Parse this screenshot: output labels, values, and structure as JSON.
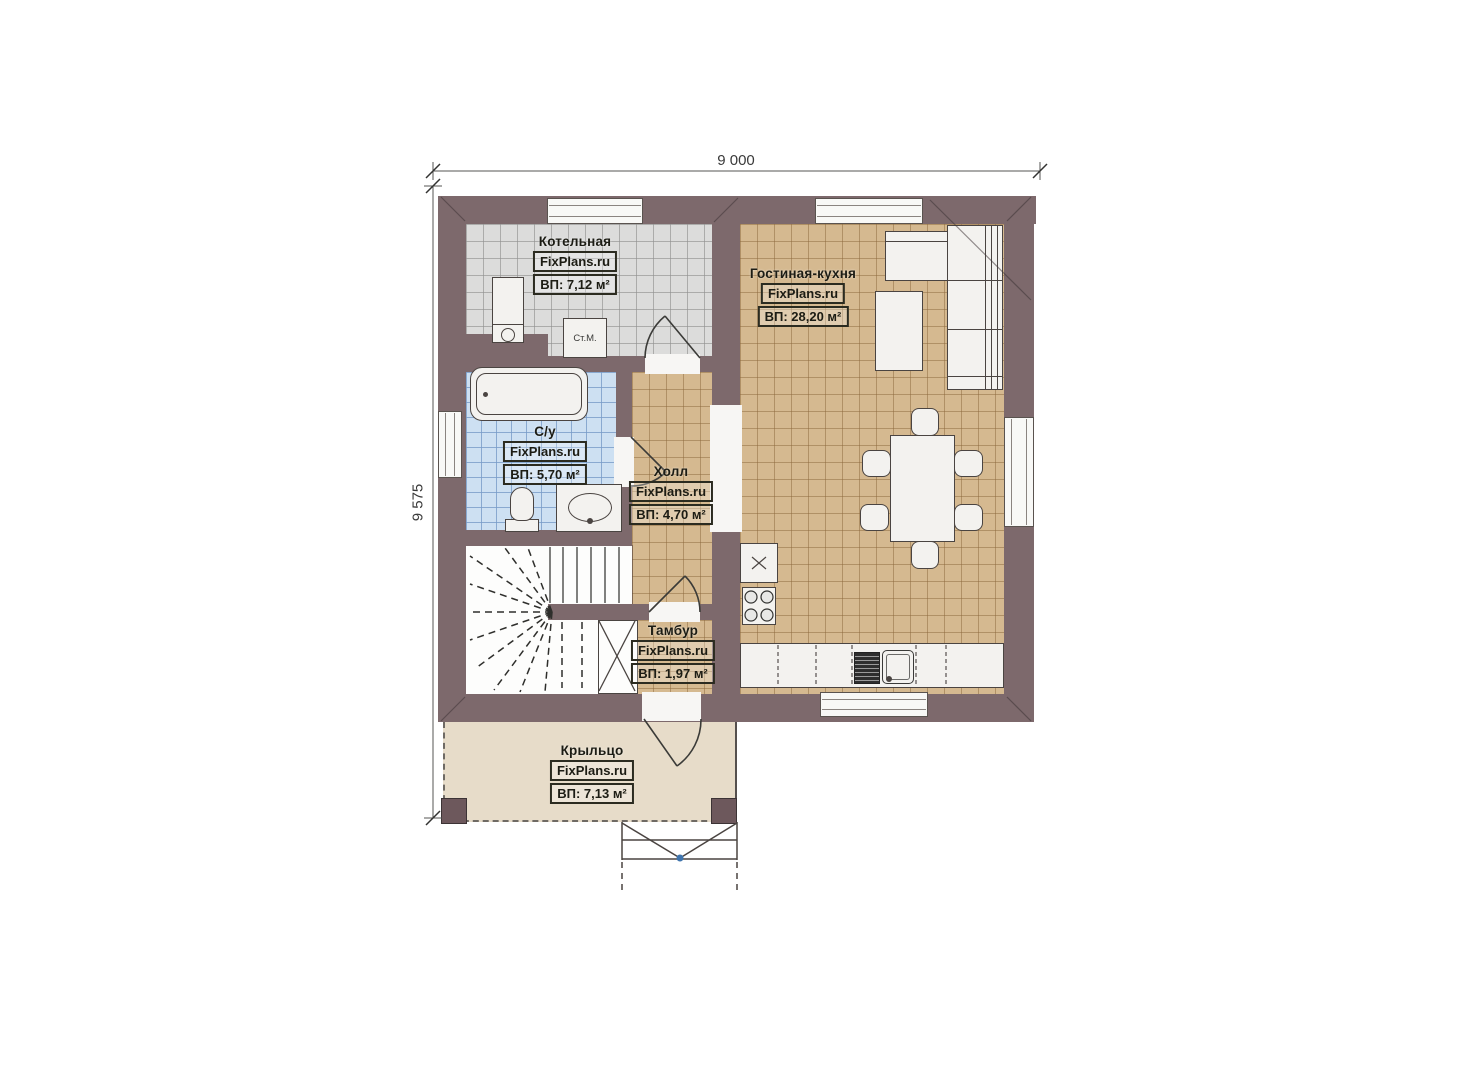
{
  "dimensions": {
    "width_label": "9 000",
    "height_label": "9 575"
  },
  "rooms": [
    {
      "id": "kotelnaya",
      "name": "Котельная",
      "brand": "FixPlans.ru",
      "area": "ВП: 7,12 м²"
    },
    {
      "id": "gostinaya",
      "name": "Гостиная-кухня",
      "brand": "FixPlans.ru",
      "area": "ВП: 28,20 м²"
    },
    {
      "id": "su",
      "name": "С/у",
      "brand": "FixPlans.ru",
      "area": "ВП: 5,70 м²"
    },
    {
      "id": "holl",
      "name": "Холл",
      "brand": "FixPlans.ru",
      "area": "ВП: 4,70 м²"
    },
    {
      "id": "tambur",
      "name": "Тамбур",
      "brand": "FixPlans.ru",
      "area": "ВП: 1,97 м²"
    },
    {
      "id": "krylco",
      "name": "Крыльцо",
      "brand": "FixPlans.ru",
      "area": "ВП: 7,13 м²"
    }
  ],
  "fixtures": {
    "washing_machine_label": "Ст.М."
  },
  "colors": {
    "wall": "#7d696c",
    "floor_tan": "#d5b990",
    "floor_grey": "#dcdcdb",
    "floor_blue": "#cde0f2",
    "porch": "#e7dcc9",
    "fixture_white": "#f3f2ef",
    "handle_dot_blue": "#3f74ad"
  }
}
